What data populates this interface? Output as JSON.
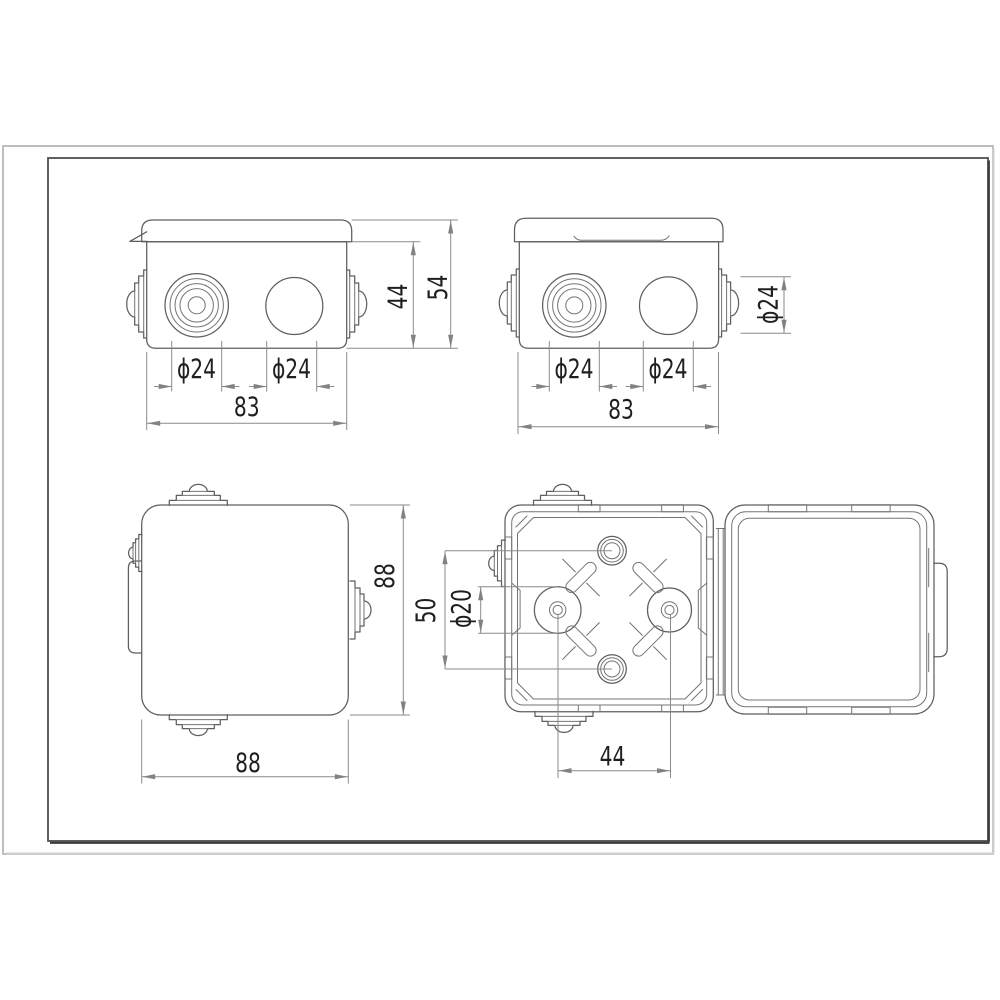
{
  "colors": {
    "background": "#ffffff",
    "object_line": "#5f5f5f",
    "dimension_line": "#8a8a8a",
    "text": "#1f1f1f",
    "inner_frame": "#4f4f4f",
    "outer_border": "#b7b7b7"
  },
  "views": {
    "front_left": {
      "dims": {
        "hole1": "ϕ24",
        "hole2": "ϕ24",
        "width": "83",
        "body_height": "44",
        "total_height": "54"
      }
    },
    "front_right": {
      "dims": {
        "hole1": "ϕ24",
        "hole2": "ϕ24",
        "width": "83",
        "side_grommet": "ϕ24"
      }
    },
    "top_closed": {
      "dims": {
        "height": "88",
        "width": "88"
      }
    },
    "open_box": {
      "dims": {
        "hole_spacing": "50",
        "boss_diameter": "ϕ20",
        "boss_spacing": "44"
      }
    }
  }
}
